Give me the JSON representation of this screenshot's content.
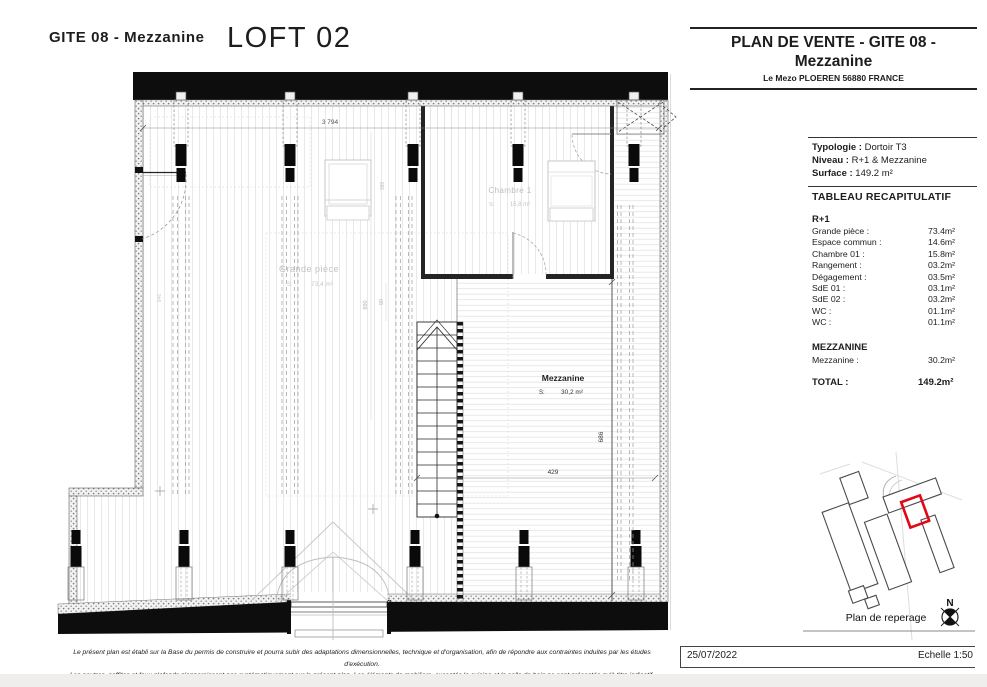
{
  "header": {
    "project_ref": "GITE 08 - Mezzanine",
    "unit_name": "LOFT 02"
  },
  "title_block": {
    "title_line1": "PLAN DE VENTE - GITE 08 -",
    "title_line2": "Mezzanine",
    "address": "Le Mezo PLOEREN 56880 FRANCE",
    "typology_label": "Typologie :",
    "typology_value": "Dortoir T3",
    "level_label": "Niveau :",
    "level_value": "R+1 & Mezzanine",
    "surface_label": "Surface :",
    "surface_value": "149.2 m²"
  },
  "recap_table": {
    "title": "TABLEAU RECAPITULATIF",
    "sections": [
      {
        "name": "R+1",
        "rows": [
          {
            "label": "Grande pièce :",
            "value": "73.4m²"
          },
          {
            "label": "Espace commun :",
            "value": "14.6m²"
          },
          {
            "label": "Chambre 01 :",
            "value": "15.8m²"
          },
          {
            "label": "Rangement :",
            "value": "03.2m²"
          },
          {
            "label": "Dégagement :",
            "value": "03.5m²"
          },
          {
            "label": "SdE 01 :",
            "value": "03.1m²"
          },
          {
            "label": "SdE 02 :",
            "value": "03.2m²"
          },
          {
            "label": "WC :",
            "value": "01.1m²"
          },
          {
            "label": "WC :",
            "value": "01.1m²"
          }
        ]
      },
      {
        "name": "MEZZANINE",
        "rows": [
          {
            "label": "Mezzanine :",
            "value": "30.2m²"
          }
        ]
      }
    ],
    "total_label": "TOTAL :",
    "total_value": "149.2m²"
  },
  "plan": {
    "rooms": [
      {
        "name": "Grande pièce",
        "s_label": "S:",
        "area": "73,4 m²"
      },
      {
        "name": "Chambre 1",
        "s_label": "S:",
        "area": "15,8 m²"
      },
      {
        "name": "Mezzanine",
        "s_label": "S:",
        "area": "30,2 m²"
      }
    ],
    "dims": {
      "width_top": "3 794",
      "mezz_width": "429",
      "mezz_height": "686",
      "d890": "890",
      "d90": "90",
      "d388": "388",
      "d846": "846"
    }
  },
  "reperage": {
    "caption": "Plan de reperage",
    "north_label": "N"
  },
  "footer": {
    "disclaimer_line1": "Le présent plan est établi sur la Base du permis de construire et pourra subir des adaptations dimensionnelles, technique et d'organisation, afin de répondre aux contraintes induites par les études d'exécution.",
    "disclaimer_line2": "Les poutres, soffites et faux-plafonds n'apparaissent pas systématiquement sur le présent plan. Les éléments de mobiliers, exceptés la cuisine et la salle de bain ne sont présentés qu'à titre indicatif.",
    "date": "25/07/2022",
    "scale": "Echelle 1:50"
  },
  "colors": {
    "accent": "#e30613",
    "ink": "#1d1d1b"
  }
}
